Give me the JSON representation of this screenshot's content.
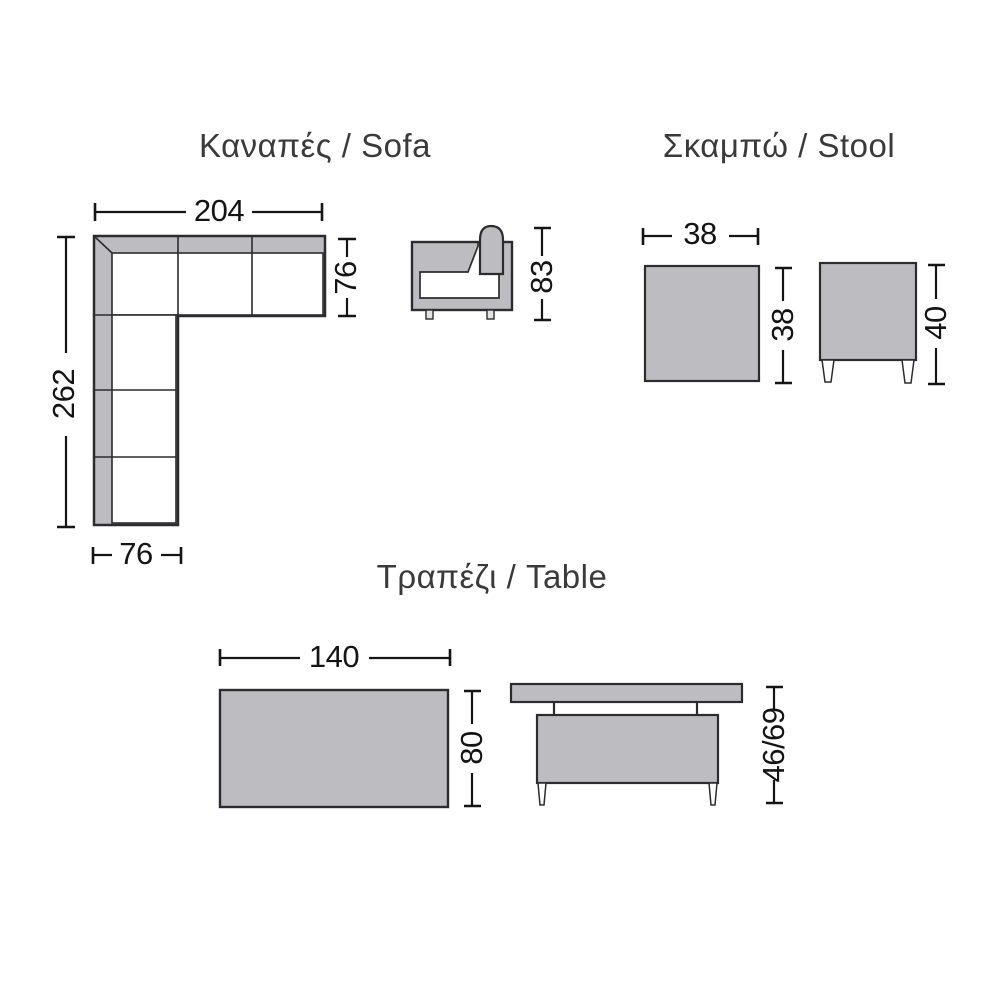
{
  "diagram": {
    "background": "#ffffff",
    "fill_gray": "#bdbdc1",
    "outline_color": "#2c2c2e",
    "dim_line_color": "#151515",
    "text_color": "#2b2b2b"
  },
  "sofa": {
    "title": "Καναπές / Sofa",
    "dims": {
      "width": "204",
      "depth": "76",
      "length": "262",
      "arm_width": "76",
      "height": "83"
    }
  },
  "stool": {
    "title": "Σκαμπώ / Stool",
    "dims": {
      "width": "38",
      "depth": "38",
      "height": "40"
    }
  },
  "table": {
    "title": "Τραπέζι / Table",
    "dims": {
      "width": "140",
      "depth": "80",
      "height": "46/69"
    }
  }
}
